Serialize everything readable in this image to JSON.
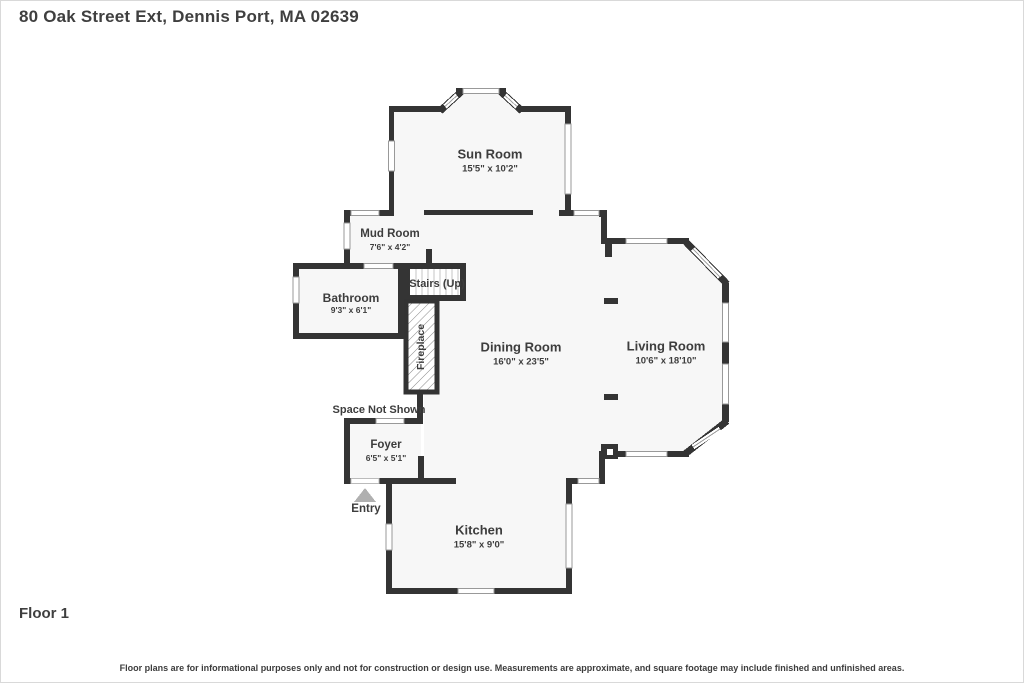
{
  "header": {
    "address": "80 Oak Street Ext, Dennis Port, MA 02639"
  },
  "floor_label": "Floor 1",
  "disclaimer": "Floor plans are for informational purposes only and not for construction or design use. Measurements are approximate, and square footage may include finished and unfinished areas.",
  "rooms": {
    "sun_room": {
      "name": "Sun Room",
      "dims": "15'5\" x 10'2\""
    },
    "mud_room": {
      "name": "Mud Room",
      "dims": "7'6\" x 4'2\""
    },
    "bathroom": {
      "name": "Bathroom",
      "dims": "9'3\" x 6'1\""
    },
    "stairs": {
      "name": "Stairs (Up)"
    },
    "fireplace": {
      "name": "Fireplace"
    },
    "dining_room": {
      "name": "Dining Room",
      "dims": "16'0\" x 23'5\""
    },
    "living_room": {
      "name": "Living Room",
      "dims": "10'6\" x 18'10\""
    },
    "space_not_shown": {
      "name": "Space Not Shown"
    },
    "foyer": {
      "name": "Foyer",
      "dims": "6'5\" x 5'1\""
    },
    "entry": {
      "name": "Entry"
    },
    "kitchen": {
      "name": "Kitchen",
      "dims": "15'8\" x 9'0\""
    }
  },
  "colors": {
    "wall": "#343434",
    "floor": "#f7f7f7",
    "text": "#3d3d3d",
    "window_outline": "#999999",
    "entry_arrow": "#b0b0b0"
  }
}
